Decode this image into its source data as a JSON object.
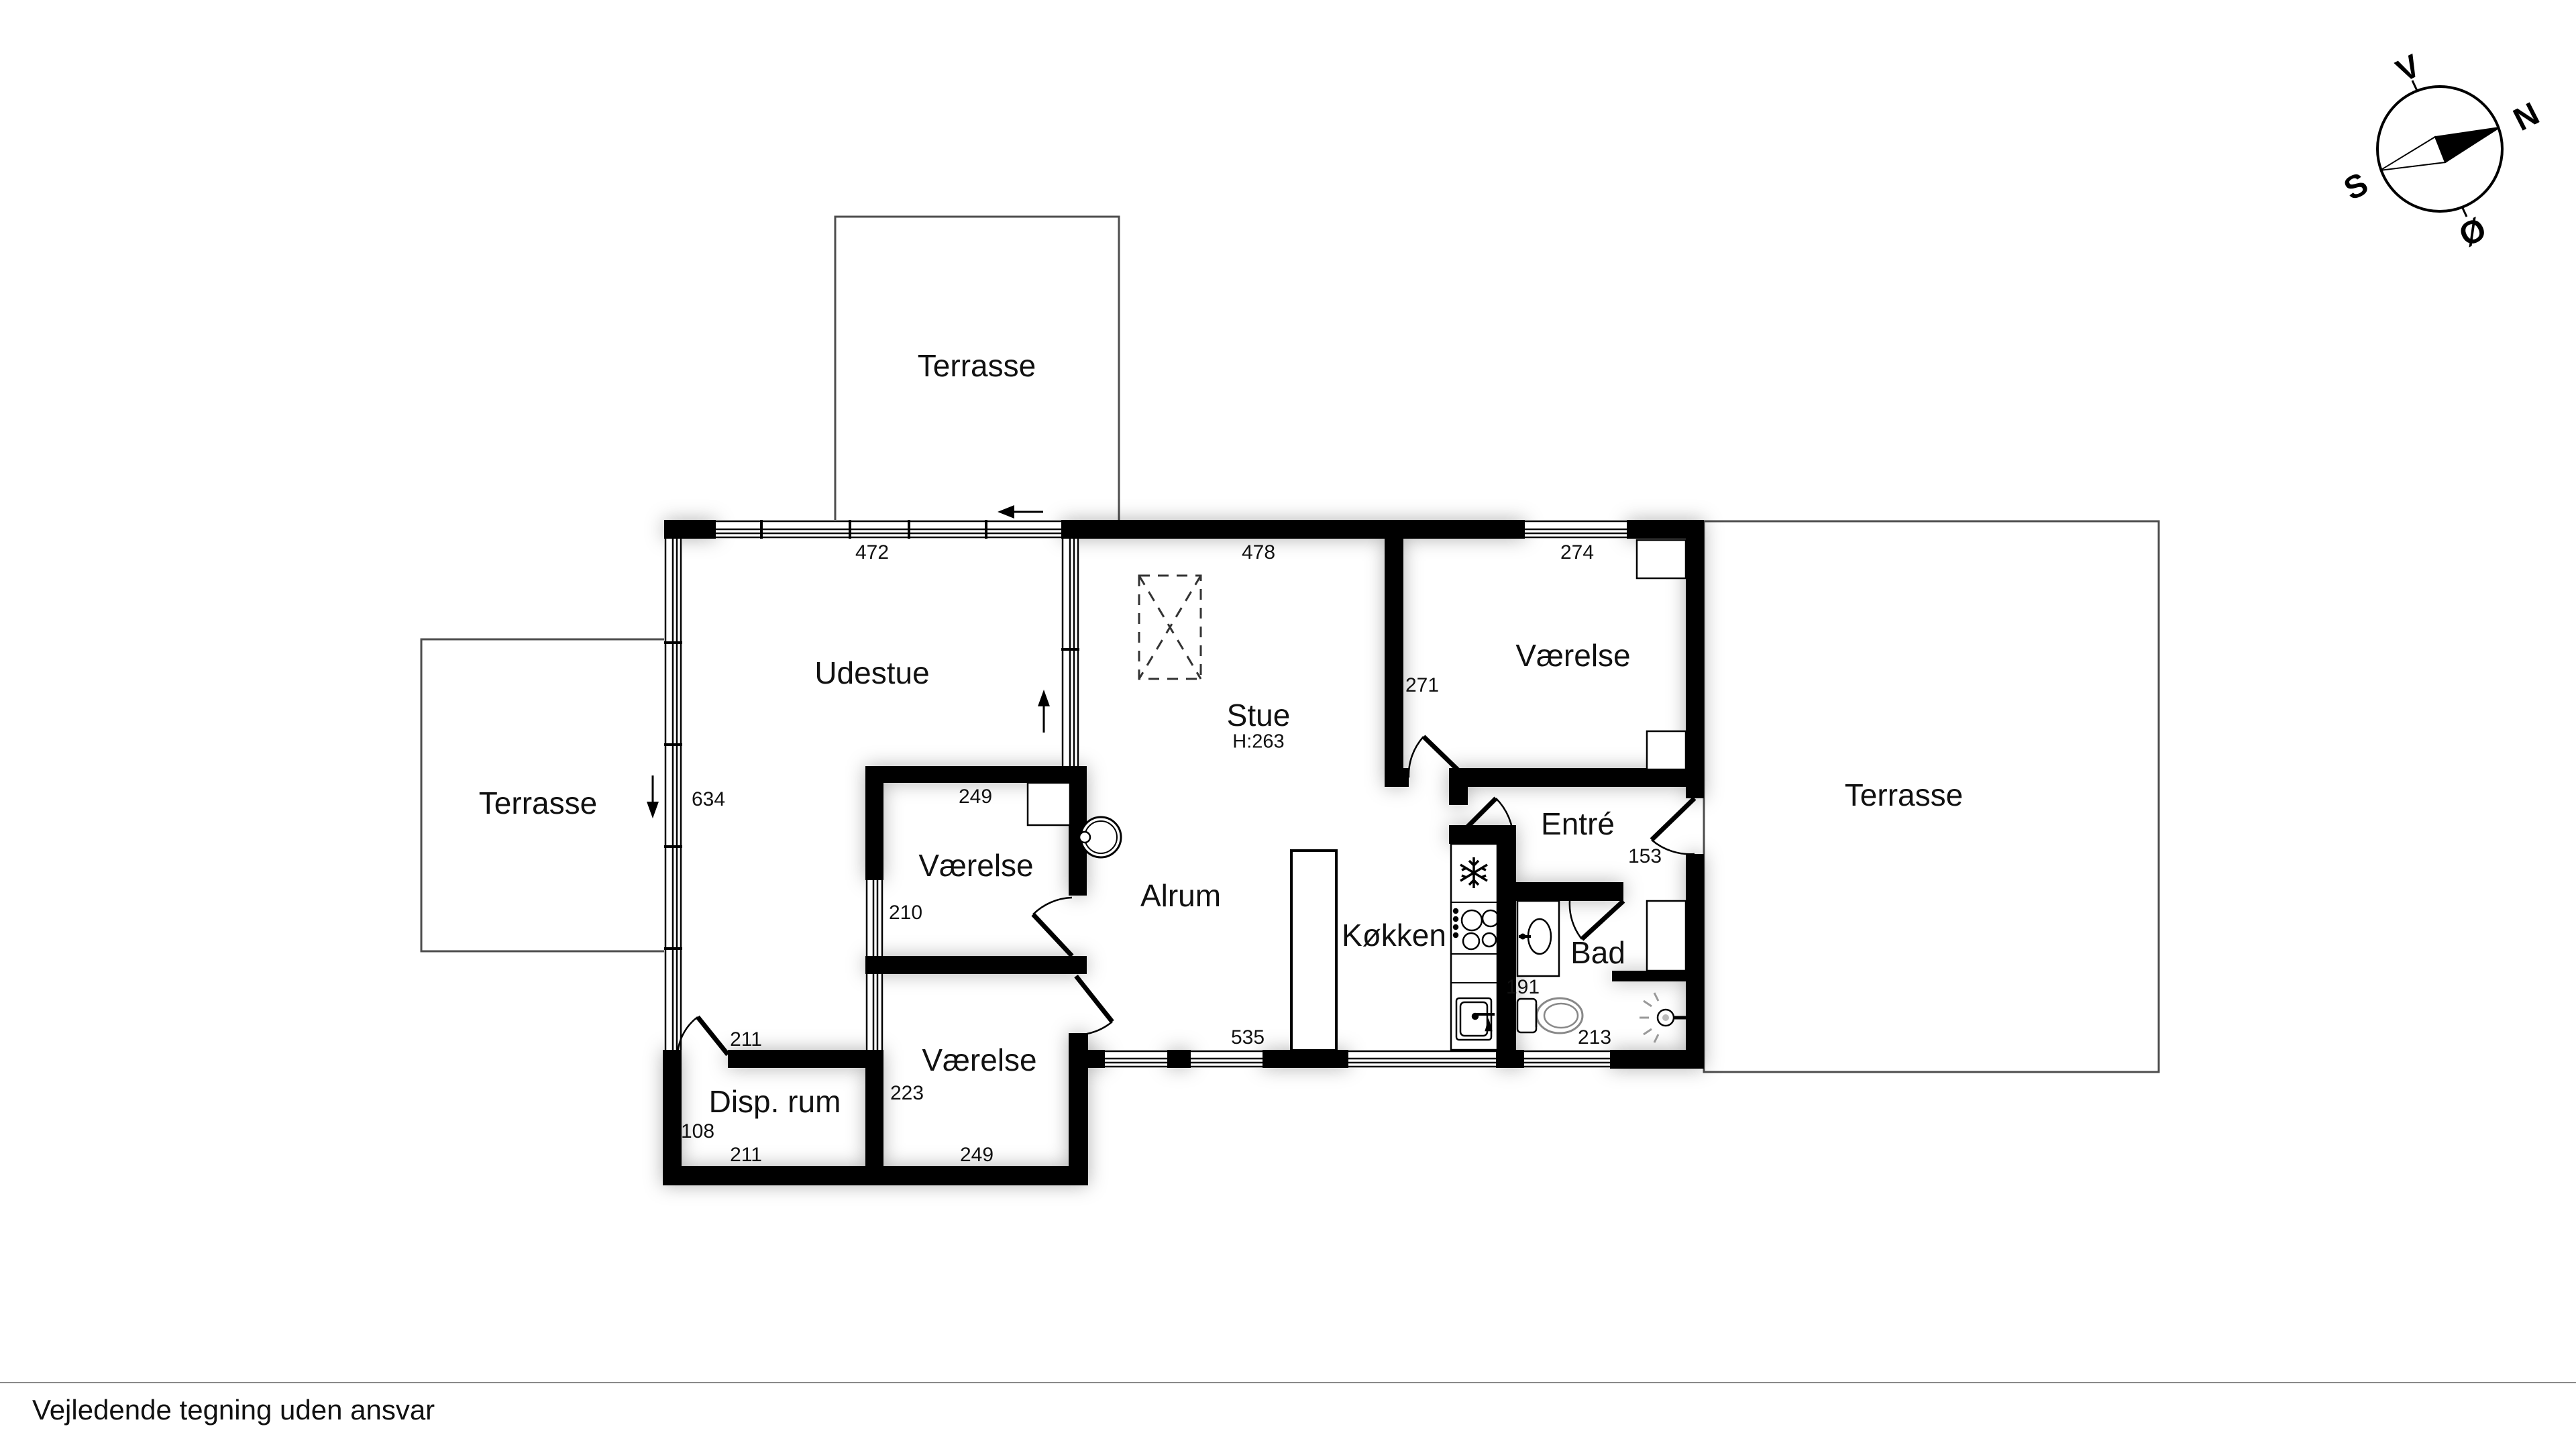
{
  "footer": {
    "disclaimer": "Vejledende tegning uden ansvar"
  },
  "compass": {
    "west": "V",
    "north": "N",
    "south": "S",
    "east": "Ø"
  },
  "rooms": {
    "terrasse_top": "Terrasse",
    "terrasse_left": "Terrasse",
    "terrasse_right": "Terrasse",
    "udestue": "Udestue",
    "stue": "Stue",
    "stue_ceiling_height": "H:263",
    "alrum": "Alrum",
    "koekken": "Køkken",
    "entre": "Entré",
    "bad": "Bad",
    "vaerelse_ne": "Værelse",
    "vaerelse_mid": "Værelse",
    "vaerelse_sw": "Værelse",
    "disp_rum": "Disp. rum"
  },
  "dimensions_cm": {
    "udestue_width": "472",
    "stue_width": "478",
    "vaerelse_ne_width": "274",
    "udestue_height": "634",
    "vaerelse_ne_height": "271",
    "vaerelse_mid_width": "249",
    "vaerelse_mid_height": "210",
    "entre_width": "153",
    "bad_width": "191",
    "bad_south_width": "213",
    "alrum_width": "535",
    "vaerelse_sw_height": "223",
    "vaerelse_sw_width": "249",
    "disp_rum_width_top": "211",
    "disp_rum_height": "108",
    "disp_rum_width_bottom": "211"
  }
}
